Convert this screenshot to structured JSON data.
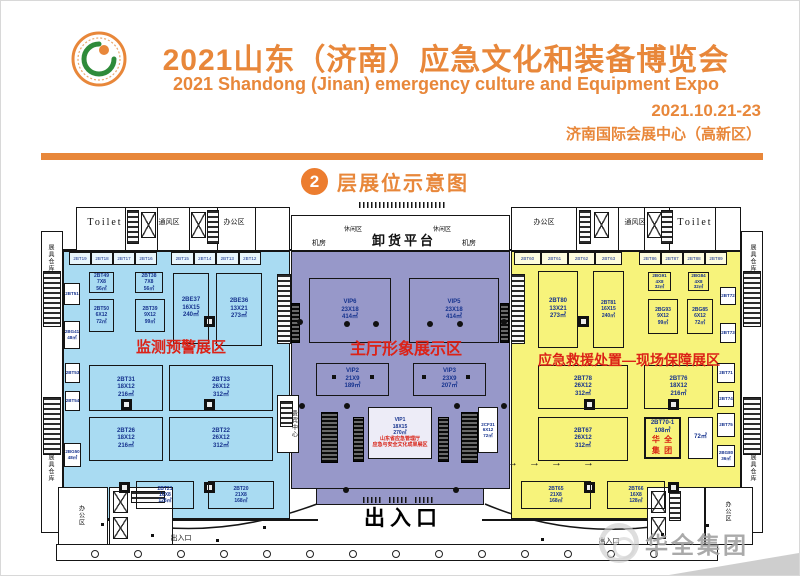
{
  "header": {
    "title_cn": "2021山东（济南）应急文化和装备博览会",
    "title_en": "2021 Shandong (Jinan) emergency culture and Equipment Expo",
    "date": "2021.10.21-23",
    "venue": "济南国际会展中心（高新区）",
    "accent_color": "#e8873a"
  },
  "section": {
    "floor_number": "2",
    "title": "层展位示意图"
  },
  "watermark": {
    "text": "华全集团"
  },
  "plan": {
    "zone_label_color": "#dc2217",
    "zones": [
      {
        "id": "monitoring",
        "label": "监测预警展区",
        "color": "#a9dbf2",
        "rect": {
          "x": 62,
          "y": 250,
          "w": 227,
          "h": 268
        },
        "label_pos": {
          "x": 110,
          "y": 339,
          "w": 140,
          "h": 16
        },
        "label_size": 15
      },
      {
        "id": "main-hall",
        "label": "主厅形象展示区",
        "color": "#9798c9",
        "rect": {
          "x": 290,
          "y": 250,
          "w": 219,
          "h": 238
        },
        "tab": {
          "x": 315,
          "y": 487,
          "w": 168,
          "h": 17
        },
        "label_pos": {
          "x": 344,
          "y": 341,
          "w": 122,
          "h": 17
        },
        "label_size": 16
      },
      {
        "id": "rescue",
        "label": "应急救援处置—现场保障展区",
        "color": "#f7f37b",
        "rect": {
          "x": 510,
          "y": 250,
          "w": 230,
          "h": 268
        },
        "label_pos": {
          "x": 522,
          "y": 352,
          "w": 212,
          "h": 15
        },
        "label_size": 14
      }
    ],
    "strips": [
      {
        "x": 68,
        "y": 251,
        "w": 88,
        "h": 13,
        "cells": [
          "2BT19",
          "2BT18",
          "2BT17",
          "2BT16"
        ]
      },
      {
        "x": 170,
        "y": 251,
        "w": 90,
        "h": 13,
        "cells": [
          "2BT15",
          "2BT14",
          "2BT13",
          "2BT12"
        ]
      },
      {
        "x": 513,
        "y": 251,
        "w": 108,
        "h": 13,
        "cells": [
          "2BT60",
          "2BT61",
          "2BT62",
          "2BT63"
        ]
      },
      {
        "x": 638,
        "y": 251,
        "w": 88,
        "h": 13,
        "cells": [
          "2BT86",
          "2BT87",
          "2BT88",
          "2BT89"
        ]
      }
    ],
    "booths": [
      {
        "zone": "monitoring",
        "x": 88,
        "y": 271,
        "w": 25,
        "h": 21,
        "lines": [
          "2BT49",
          "7X8",
          "56㎡"
        ],
        "cls": "fs5"
      },
      {
        "zone": "monitoring",
        "x": 134,
        "y": 271,
        "w": 28,
        "h": 21,
        "lines": [
          "2BT38",
          "7X8",
          "56㎡"
        ],
        "cls": "fs5"
      },
      {
        "zone": "monitoring",
        "x": 88,
        "y": 298,
        "w": 25,
        "h": 33,
        "lines": [
          "2BT50",
          "6X12",
          "72㎡"
        ],
        "cls": "fs5"
      },
      {
        "zone": "monitoring",
        "x": 134,
        "y": 298,
        "w": 30,
        "h": 33,
        "lines": [
          "2BT39",
          "9X12",
          "99㎡"
        ],
        "cls": "fs5"
      },
      {
        "zone": "monitoring",
        "x": 172,
        "y": 272,
        "w": 36,
        "h": 71,
        "lines": [
          "2BE37",
          "16X15",
          "240㎡"
        ]
      },
      {
        "zone": "monitoring",
        "x": 215,
        "y": 272,
        "w": 46,
        "h": 73,
        "lines": [
          "2BE36",
          "13X21",
          "273㎡"
        ]
      },
      {
        "zone": "monitoring",
        "x": 88,
        "y": 364,
        "w": 74,
        "h": 46,
        "lines": [
          "2BT31",
          "18X12",
          "216㎡"
        ]
      },
      {
        "zone": "monitoring",
        "x": 168,
        "y": 364,
        "w": 104,
        "h": 46,
        "lines": [
          "2BT33",
          "26X12",
          "312㎡"
        ]
      },
      {
        "zone": "monitoring",
        "x": 88,
        "y": 416,
        "w": 74,
        "h": 44,
        "lines": [
          "2BT26",
          "18X12",
          "216㎡"
        ]
      },
      {
        "zone": "monitoring",
        "x": 168,
        "y": 416,
        "w": 104,
        "h": 44,
        "lines": [
          "2BT22",
          "26X12",
          "312㎡"
        ]
      },
      {
        "zone": "monitoring",
        "x": 135,
        "y": 480,
        "w": 58,
        "h": 28,
        "lines": [
          "2BT21",
          "16X8",
          "128㎡"
        ],
        "cls": "fs5"
      },
      {
        "zone": "monitoring",
        "x": 207,
        "y": 480,
        "w": 66,
        "h": 28,
        "lines": [
          "2BT20",
          "21X8",
          "168㎡"
        ],
        "cls": "fs5"
      },
      {
        "zone": "monitoring",
        "x": 63,
        "y": 282,
        "w": 16,
        "h": 22,
        "lines": [
          "2BT51"
        ],
        "cls": "micro"
      },
      {
        "zone": "monitoring",
        "x": 63,
        "y": 320,
        "w": 16,
        "h": 28,
        "lines": [
          "2BG41",
          "48㎡"
        ],
        "cls": "micro"
      },
      {
        "zone": "monitoring",
        "x": 64,
        "y": 362,
        "w": 15,
        "h": 20,
        "lines": [
          "2BT53"
        ],
        "cls": "micro"
      },
      {
        "zone": "monitoring",
        "x": 64,
        "y": 390,
        "w": 15,
        "h": 20,
        "lines": [
          "2BT54"
        ],
        "cls": "micro"
      },
      {
        "zone": "monitoring",
        "x": 63,
        "y": 442,
        "w": 17,
        "h": 24,
        "lines": [
          "2BG50",
          "48㎡"
        ],
        "cls": "micro"
      },
      {
        "zone": "main-hall",
        "x": 308,
        "y": 277,
        "w": 82,
        "h": 65,
        "lines": [
          "VIP6",
          "23X18",
          "414㎡"
        ]
      },
      {
        "zone": "main-hall",
        "x": 408,
        "y": 277,
        "w": 90,
        "h": 65,
        "lines": [
          "VIP5",
          "23X18",
          "414㎡"
        ]
      },
      {
        "zone": "main-hall",
        "x": 315,
        "y": 362,
        "w": 73,
        "h": 33,
        "lines": [
          "VIP2",
          "21X9",
          "189㎡"
        ]
      },
      {
        "zone": "main-hall",
        "x": 412,
        "y": 362,
        "w": 73,
        "h": 33,
        "lines": [
          "VIP3",
          "23X9",
          "207㎡"
        ]
      },
      {
        "zone": "main-hall",
        "x": 367,
        "y": 406,
        "w": 64,
        "h": 52,
        "lines": [
          "VIP1",
          "18X15",
          "270㎡"
        ],
        "red": [
          "山东省应急管理厅",
          "应急与安全文化成果展区"
        ],
        "cls": "vip1 fs5"
      },
      {
        "zone": "main-hall",
        "x": 477,
        "y": 406,
        "w": 20,
        "h": 46,
        "lines": [
          "2CF31",
          "6X12",
          "72㎡"
        ],
        "cls": "white fs4"
      },
      {
        "zone": "rescue",
        "x": 537,
        "y": 270,
        "w": 40,
        "h": 77,
        "lines": [
          "2BT80",
          "13X21",
          "273㎡"
        ]
      },
      {
        "zone": "rescue",
        "x": 592,
        "y": 270,
        "w": 31,
        "h": 77,
        "lines": [
          "2BT81",
          "16X15",
          "240㎡"
        ],
        "cls": "fs5"
      },
      {
        "zone": "rescue",
        "x": 647,
        "y": 271,
        "w": 23,
        "h": 19,
        "lines": [
          "2BG91",
          "4X8",
          "32㎡"
        ],
        "cls": "fs4"
      },
      {
        "zone": "rescue",
        "x": 687,
        "y": 271,
        "w": 21,
        "h": 19,
        "lines": [
          "2BG84",
          "4X8",
          "32㎡"
        ],
        "cls": "fs4"
      },
      {
        "zone": "rescue",
        "x": 647,
        "y": 298,
        "w": 30,
        "h": 35,
        "lines": [
          "2BG93",
          "9X12",
          "99㎡"
        ],
        "cls": "fs5"
      },
      {
        "zone": "rescue",
        "x": 686,
        "y": 298,
        "w": 26,
        "h": 35,
        "lines": [
          "2BG85",
          "6X12",
          "72㎡"
        ],
        "cls": "fs5"
      },
      {
        "zone": "rescue",
        "x": 537,
        "y": 364,
        "w": 90,
        "h": 44,
        "lines": [
          "2BT78",
          "26X12",
          "312㎡"
        ]
      },
      {
        "zone": "rescue",
        "x": 643,
        "y": 364,
        "w": 69,
        "h": 44,
        "lines": [
          "2BT76",
          "18X12",
          "216㎡"
        ]
      },
      {
        "zone": "rescue",
        "x": 537,
        "y": 416,
        "w": 90,
        "h": 44,
        "lines": [
          "2BT67",
          "26X12",
          "312㎡"
        ]
      },
      {
        "zone": "rescue",
        "x": 643,
        "y": 416,
        "w": 37,
        "h": 42,
        "lines": [
          "2BT70-1",
          "108㎡"
        ],
        "red": [
          "华 全",
          "集 团"
        ],
        "cls": "hl"
      },
      {
        "zone": "rescue",
        "x": 687,
        "y": 416,
        "w": 25,
        "h": 42,
        "lines": [
          "72㎡"
        ],
        "cls": "white"
      },
      {
        "zone": "rescue",
        "x": 520,
        "y": 480,
        "w": 70,
        "h": 28,
        "lines": [
          "2BT65",
          "21X8",
          "168㎡"
        ],
        "cls": "fs5"
      },
      {
        "zone": "rescue",
        "x": 606,
        "y": 480,
        "w": 58,
        "h": 28,
        "lines": [
          "2BT66",
          "16X8",
          "128㎡"
        ],
        "cls": "fs5"
      },
      {
        "zone": "rescue",
        "x": 719,
        "y": 286,
        "w": 16,
        "h": 18,
        "lines": [
          "2BT72"
        ],
        "cls": "micro"
      },
      {
        "zone": "rescue",
        "x": 719,
        "y": 322,
        "w": 16,
        "h": 20,
        "lines": [
          "2BT73"
        ],
        "cls": "micro"
      },
      {
        "zone": "rescue",
        "x": 716,
        "y": 362,
        "w": 18,
        "h": 20,
        "lines": [
          "2BT71"
        ],
        "cls": "micro"
      },
      {
        "zone": "rescue",
        "x": 717,
        "y": 390,
        "w": 16,
        "h": 16,
        "lines": [
          "2BT74"
        ],
        "cls": "micro"
      },
      {
        "zone": "rescue",
        "x": 716,
        "y": 412,
        "w": 18,
        "h": 24,
        "lines": [
          "2BT75"
        ],
        "cls": "micro"
      },
      {
        "zone": "rescue",
        "x": 716,
        "y": 444,
        "w": 18,
        "h": 22,
        "lines": [
          "2BG80",
          "36㎡"
        ],
        "cls": "micro"
      }
    ],
    "facilities": [
      {
        "id": "toilet-left-label",
        "text": "Toilet",
        "x": 83,
        "y": 211,
        "w": 42,
        "h": 22,
        "cls": "f-toilet"
      },
      {
        "id": "vent-left-label",
        "text": "通风区",
        "x": 152,
        "y": 215,
        "w": 32,
        "h": 12,
        "cls": "f-room"
      },
      {
        "id": "office-top-left-label",
        "text": "办公区",
        "x": 214,
        "y": 215,
        "w": 38,
        "h": 12,
        "cls": "f-room"
      },
      {
        "id": "leisure-left-label",
        "text": "休闲区",
        "x": 339,
        "y": 224,
        "w": 26,
        "h": 10,
        "cls": "f-tiny"
      },
      {
        "id": "leisure-right-label",
        "text": "休闲区",
        "x": 428,
        "y": 224,
        "w": 26,
        "h": 10,
        "cls": "f-tiny"
      },
      {
        "id": "machine-room-left-label",
        "text": "机房",
        "x": 307,
        "y": 236,
        "w": 22,
        "h": 12,
        "cls": "f-room"
      },
      {
        "id": "machine-room-right-label",
        "text": "机房",
        "x": 457,
        "y": 236,
        "w": 22,
        "h": 12,
        "cls": "f-room"
      },
      {
        "id": "unloading-dock-label",
        "text": "卸货平台",
        "x": 368,
        "y": 230,
        "w": 70,
        "h": 18,
        "cls": "f-dock"
      },
      {
        "id": "office-top-right-label",
        "text": "办公区",
        "x": 524,
        "y": 215,
        "w": 38,
        "h": 12,
        "cls": "f-room"
      },
      {
        "id": "vent-right-label",
        "text": "通风区",
        "x": 618,
        "y": 215,
        "w": 32,
        "h": 12,
        "cls": "f-room"
      },
      {
        "id": "toilet-right-label",
        "text": "Toilet",
        "x": 672,
        "y": 211,
        "w": 44,
        "h": 22,
        "cls": "f-toilet"
      },
      {
        "id": "warehouse-left-top-label",
        "text": "展具仓库",
        "x": 42,
        "y": 234,
        "w": 14,
        "h": 46,
        "cls": "f-vert"
      },
      {
        "id": "warehouse-left-bottom-label",
        "text": "展具仓库",
        "x": 42,
        "y": 444,
        "w": 14,
        "h": 46,
        "cls": "f-vert"
      },
      {
        "id": "warehouse-right-top-label",
        "text": "展具仓库",
        "x": 744,
        "y": 234,
        "w": 14,
        "h": 46,
        "cls": "f-vert"
      },
      {
        "id": "warehouse-right-bottom-label",
        "text": "展具仓库",
        "x": 744,
        "y": 444,
        "w": 14,
        "h": 46,
        "cls": "f-vert"
      },
      {
        "id": "vip-center-label",
        "text": "贵宾中心",
        "x": 288,
        "y": 400,
        "w": 9,
        "h": 46,
        "cls": "f-vert"
      },
      {
        "id": "office-bottom-left-label",
        "text": "办公区",
        "x": 73,
        "y": 492,
        "w": 13,
        "h": 44,
        "cls": "f-vert"
      },
      {
        "id": "office-bottom-right-label",
        "text": "办公区",
        "x": 720,
        "y": 490,
        "w": 12,
        "h": 40,
        "cls": "f-vert"
      },
      {
        "id": "exit-main-label",
        "text": "出入口",
        "x": 360,
        "y": 504,
        "w": 84,
        "h": 26,
        "cls": "f-exit"
      },
      {
        "id": "exit-left-label",
        "text": "出入口",
        "x": 166,
        "y": 532,
        "w": 28,
        "h": 10,
        "cls": "f-exit-sm"
      },
      {
        "id": "exit-right-label",
        "text": "出入口",
        "x": 594,
        "y": 535,
        "w": 28,
        "h": 10,
        "cls": "f-exit-sm"
      }
    ],
    "arrows": {
      "symbol": "→",
      "positions": [
        [
          506,
          456
        ],
        [
          528,
          456
        ],
        [
          550,
          456
        ],
        [
          582,
          456
        ]
      ]
    }
  }
}
